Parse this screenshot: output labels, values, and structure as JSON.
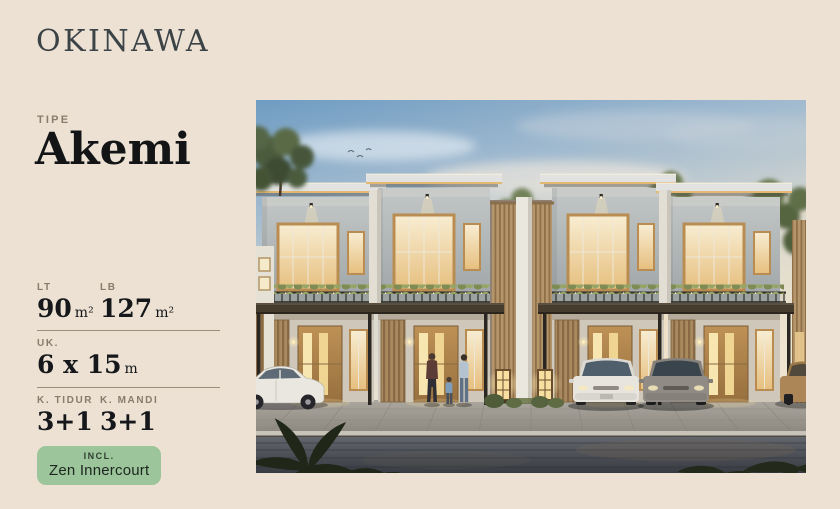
{
  "page": {
    "background_color": "#ECE1D3"
  },
  "header": {
    "brand": "OKINAWA"
  },
  "unit": {
    "type_label": "TIPE",
    "type_name": "Akemi"
  },
  "specs": {
    "rows": [
      {
        "cols": [
          {
            "label": "LT",
            "value": "90",
            "unit": "m²"
          },
          {
            "label": "LB",
            "value": "127",
            "unit": "m²"
          }
        ]
      },
      {
        "cols": [
          {
            "label": "UK.",
            "value": "6 x 15",
            "unit": "m"
          }
        ]
      },
      {
        "cols": [
          {
            "label": "K. TIDUR",
            "value": "3+1",
            "unit": ""
          },
          {
            "label": "K. MANDI",
            "value": "3+1",
            "unit": ""
          }
        ]
      }
    ]
  },
  "badge": {
    "label": "INCL.",
    "value": "Zen Innercourt",
    "background_color": "#9CC59B"
  },
  "hero": {
    "alt": "Dusk rendering of four modern two-storey Japanese-style townhouses with cantilevered lit roofs, timber slat screens, balcony planters, parked sedans, stone lanterns and a family of three walking on the paved driveway"
  },
  "colors": {
    "title": "#3C4347",
    "label": "#8A7C6A",
    "value": "#15171A",
    "divider": "#9B8E7B",
    "badge_background": "#9CC59B"
  }
}
